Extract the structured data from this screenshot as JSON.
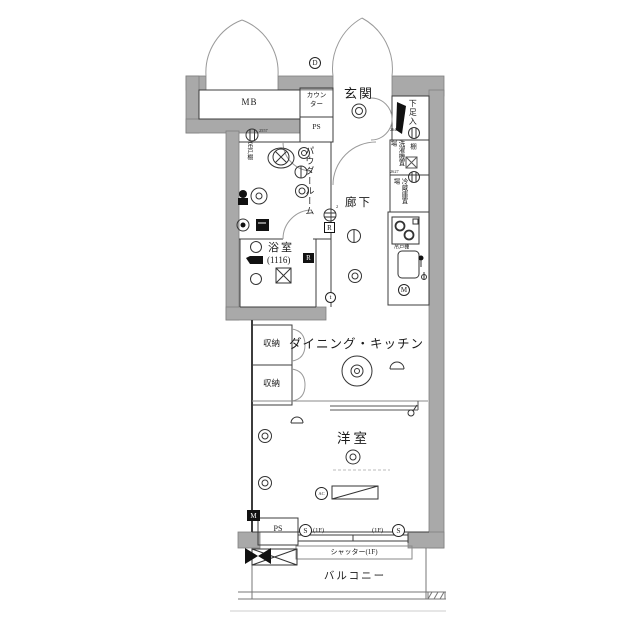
{
  "plan_title": "floor-plan",
  "rooms": {
    "meter_box": "MB",
    "counter": "カウン\nター",
    "ps_upper": "PS",
    "entrance": "玄関",
    "shoe_cabinet": "下足入",
    "hanging_cupboard": "吊戸棚",
    "powder_room": "パウダールーム",
    "hallway": "廊下",
    "washer_place": "洗濯機置場",
    "shelf": "棚",
    "fridge_place": "冷蔵庫置場",
    "kitchen_hanging_cupboard": "吊戸棚",
    "bathroom": "浴室",
    "bathroom_module": "(1116)",
    "dining_kitchen": "ダイニング・キッチン",
    "storage_1": "収納",
    "storage_2": "収納",
    "western_room": "洋室",
    "ps_lower": "PS",
    "shutter": "シャッター(1F)",
    "balcony": "バルコニー"
  },
  "markers": {
    "circled_d": "D",
    "circled_t": "t",
    "circled_m": "M",
    "boxed_m": "M",
    "bath_r": "R",
    "hall_r": "R",
    "ac": "AC",
    "s_left": "S",
    "floor_left": "(1F)",
    "floor_right": "(1F)",
    "s_right": "S",
    "code_cupboard": "2557",
    "code_washer": "2641",
    "code_fridge": "2627",
    "outlet_sup": "2"
  },
  "colors": {
    "wall": "#a9a9a9",
    "line": "#3c3c3c",
    "text": "#1b1b1b"
  }
}
